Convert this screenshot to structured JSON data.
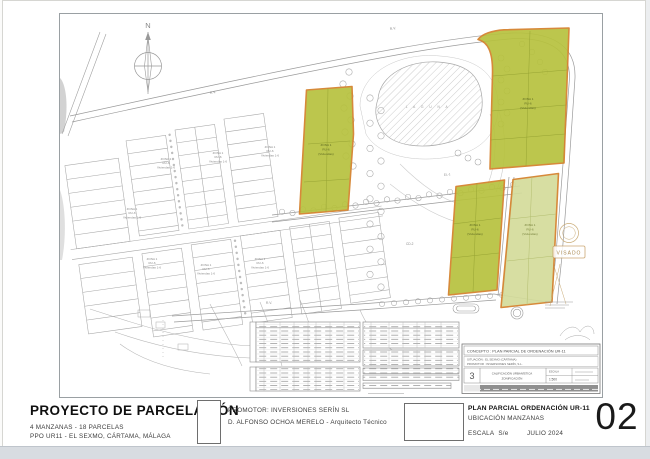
{
  "sheet": {
    "number": "02",
    "title_block": {
      "project_title": "PROYECTO DE PARCELACIÓN",
      "project_sub1": "4 MANZANAS - 18 PARCELAS",
      "project_sub2": "PPO UR11 - EL SEXMO, CÁRTAMA, MÁLAGA",
      "promoter_line1": "PROMOTOR:   INVERSIONES SERÍN SL",
      "promoter_line2": "D. ALFONSO OCHOA MERELO - Arquitecto Técnico",
      "drawing_title": "PLAN PARCIAL ORDENACIÓN UR-11",
      "drawing_subtitle": "UBICACIÓN MANZANAS",
      "scale_label": "ESCALA",
      "scale_value": "S/e",
      "date": "JULIO 2024"
    }
  },
  "map": {
    "north_label": "N",
    "road_label": "R.V.",
    "el_label": "EL-1",
    "cd_label": "CD-2",
    "pond_label": "L A G U N A",
    "visado_label": "VISADO",
    "zona": {
      "l1": "ZONA 1",
      "l2": "RU-6",
      "l3": "Viviendas 1-6"
    },
    "green": {
      "l1": "ZONA 1",
      "l2": "RU-6",
      "l3": "(Viviendas)"
    },
    "inner_title_block": {
      "concepto": "CONCEPTO :  PLAN PARCIAL DE ORDENACIÓN UR-11",
      "situacion": "SITUACIÓN :  EL SEXMO (CÁRTAMA)",
      "promotor": "PROMOTOR :  INVERSIONES SERÍN, S.L.",
      "plano_num": "3",
      "plano_title1": "CALIFICACIÓN URBANÍSTICA",
      "plano_title2": "ZONIFICACIÓN",
      "escala_label": "ESCALA",
      "escala_value": "1:500"
    }
  },
  "colors": {
    "parcel_green": "#b7c23e",
    "parcel_green_light": "#d4dc9b",
    "parcel_border": "#d4802a",
    "linework_grey": "#a4a4a4"
  }
}
